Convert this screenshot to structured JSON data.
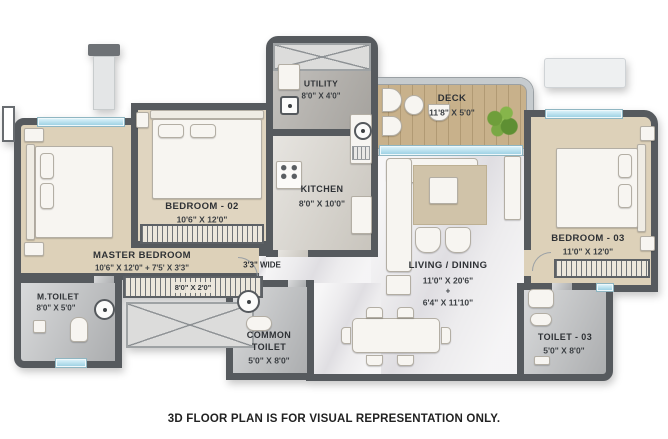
{
  "colors": {
    "wall": "#565a5e",
    "floor_beige": "#ddd1b9",
    "floor_marble": "#edecee",
    "floor_wood": "#c8b18b",
    "floor_tile": "#bfc1c3",
    "floor_concrete": "#b3b0ab",
    "window_blue": "#a9dcec",
    "plant_green": "#7aa844",
    "label_text": "#2e3135"
  },
  "rooms": {
    "utility": {
      "name": "UTILITY",
      "dims": "8'0\" X 4'0\""
    },
    "deck": {
      "name": "DECK",
      "dims": "11'8\" X 5'0\""
    },
    "kitchen": {
      "name": "KITCHEN",
      "dims": "8'0\" X 10'0\""
    },
    "bedroom_02": {
      "name": "BEDROOM - 02",
      "dims": "10'6\" X 12'0\""
    },
    "master_bedroom": {
      "name": "MASTER BEDROOM",
      "dims": "10'6\" X 12'0\" + 7'5' X 3'3\""
    },
    "master_wardrobe": {
      "dims": "8'0\" X 2'0\""
    },
    "m_toilet": {
      "name": "M.TOILET",
      "dims": "8'0\" X 5'0\""
    },
    "passage": {
      "dims": "3'3\" WIDE"
    },
    "common_toilet": {
      "name_line1": "COMMON",
      "name_line2": "TOILET",
      "dims": "5'0\" X 8'0\""
    },
    "living_dining": {
      "name": "LIVING / DINING",
      "dims_primary": "11'0\" X 20'6\"",
      "plus_sign": "+",
      "dims_secondary": "6'4\" X 11'10\""
    },
    "bedroom_03": {
      "name": "BEDROOM - 03",
      "dims": "11'0\" X 12'0\""
    },
    "toilet_03": {
      "name": "TOILET - 03",
      "dims": "5'0\" X 8'0\""
    }
  },
  "footer": {
    "disclaimer": "3D FLOOR PLAN IS FOR VISUAL REPRESENTATION ONLY."
  }
}
